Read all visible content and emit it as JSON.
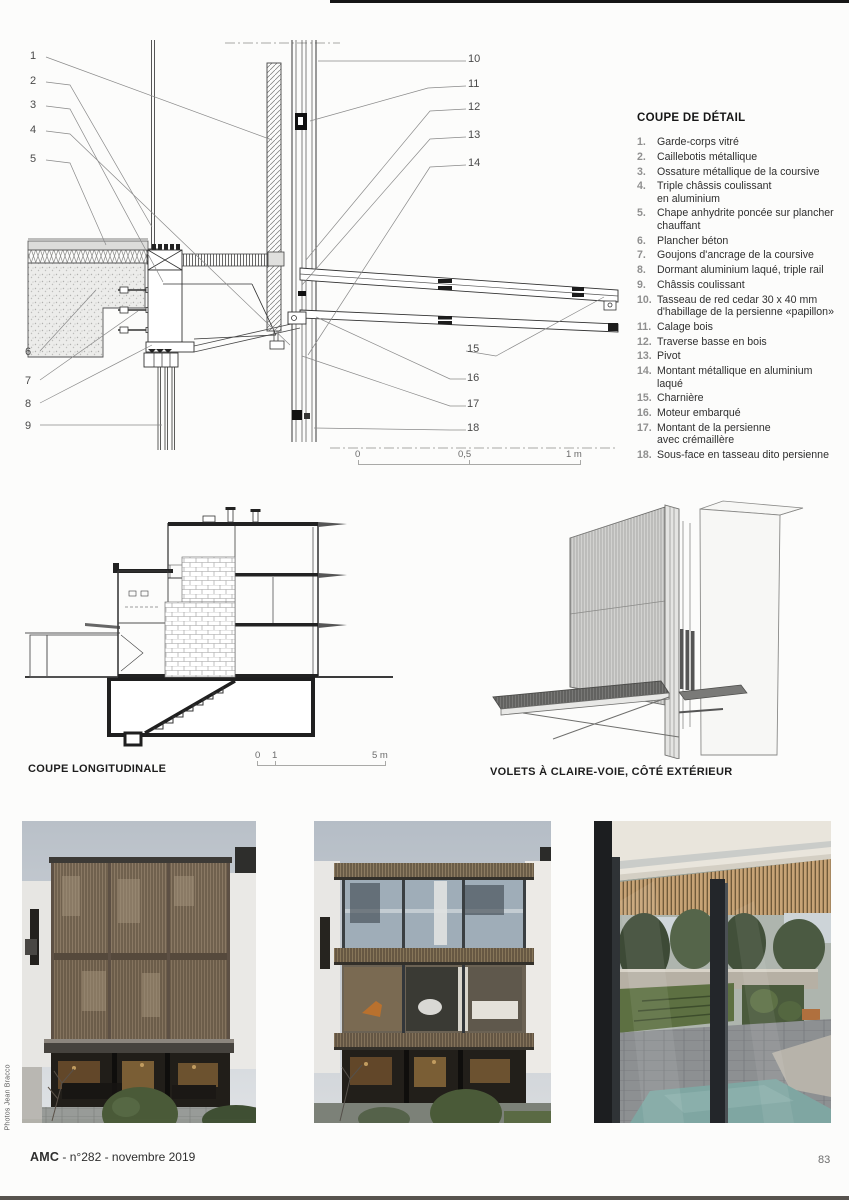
{
  "detail_drawing": {
    "legend_title": "COUPE DE DÉTAIL",
    "legend_items": [
      {
        "num": "1.",
        "text": "Garde-corps vitré"
      },
      {
        "num": "2.",
        "text": "Caillebotis métallique"
      },
      {
        "num": "3.",
        "text": "Ossature métallique de la coursive"
      },
      {
        "num": "4.",
        "text": "Triple châssis coulissant\nen aluminium"
      },
      {
        "num": "5.",
        "text": "Chape anhydrite poncée sur plancher\nchauffant"
      },
      {
        "num": "6.",
        "text": "Plancher béton"
      },
      {
        "num": "7.",
        "text": "Goujons d'ancrage de la coursive"
      },
      {
        "num": "8.",
        "text": "Dormant aluminium laqué, triple rail"
      },
      {
        "num": "9.",
        "text": "Châssis coulissant"
      },
      {
        "num": "10.",
        "text": "Tasseau de red cedar 30 x 40 mm\nd'habillage de la persienne «papillon»"
      },
      {
        "num": "11.",
        "text": "Calage bois"
      },
      {
        "num": "12.",
        "text": "Traverse basse en bois"
      },
      {
        "num": "13.",
        "text": "Pivot"
      },
      {
        "num": "14.",
        "text": "Montant métallique en aluminium\nlaqué"
      },
      {
        "num": "15.",
        "text": "Charnière"
      },
      {
        "num": "16.",
        "text": "Moteur embarqué"
      },
      {
        "num": "17.",
        "text": "Montant de la persienne\navec crémaillère"
      },
      {
        "num": "18.",
        "text": "Sous-face en tasseau dito persienne"
      }
    ],
    "callouts": [
      "1",
      "2",
      "3",
      "4",
      "5",
      "6",
      "7",
      "8",
      "9",
      "10",
      "11",
      "12",
      "13",
      "14",
      "15",
      "16",
      "17",
      "18"
    ],
    "scale_bar": {
      "t0": "0",
      "t1": "0,5",
      "t2": "1 m"
    }
  },
  "longitudinal_section": {
    "caption": "COUPE LONGITUDINALE",
    "scale_bar": {
      "t0": "0",
      "t1": "1",
      "t2": "5 m"
    }
  },
  "axonometric": {
    "caption": "VOLETS À CLAIRE-VOIE, CÔTÉ EXTÉRIEUR"
  },
  "photos": {
    "credit": "Photos Jean Bracco"
  },
  "footer": {
    "brand": "AMC",
    "issue": " - n°282 - novembre 2019",
    "page_number": "83"
  },
  "palette": {
    "facade_wood": "#8a7964",
    "awning_dark": "#46433e",
    "interior_warm": "#8a6a3a",
    "lawn_green": "#5d7042",
    "pool_teal": "#7fa6a2",
    "sky_gray": "#c3c9cf"
  }
}
